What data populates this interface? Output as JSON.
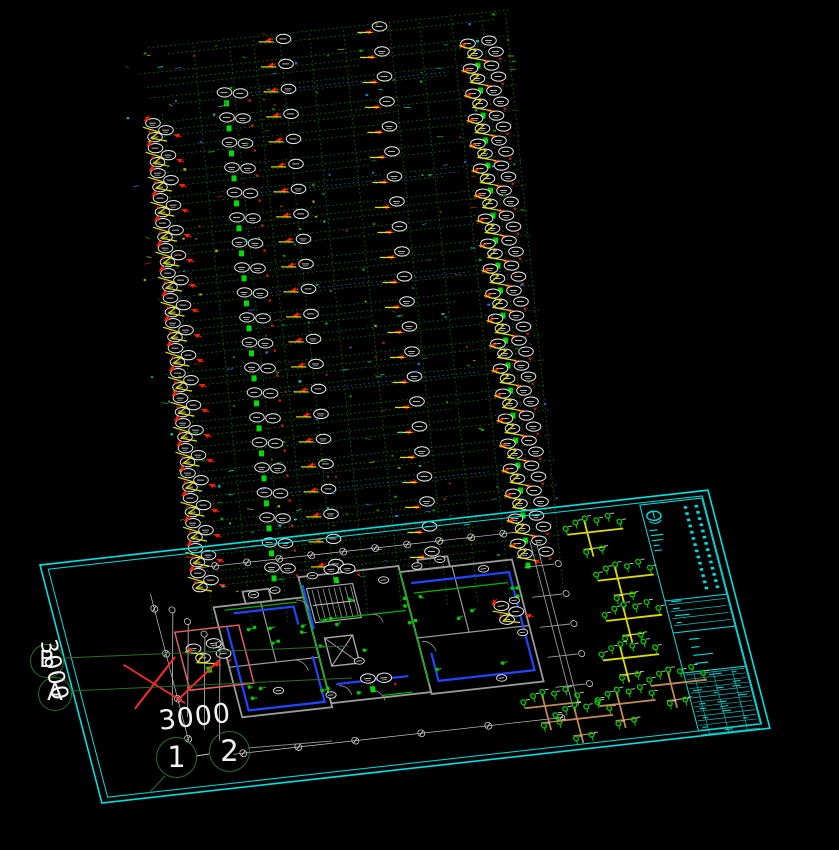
{
  "meta": {
    "app": "CAD drawing viewport",
    "description": "Electrical riser diagram above rotated floor-plan sheet with title block"
  },
  "palette": {
    "background": "#000000",
    "cyan": "#00E0E0",
    "riser_green": "#0A780A",
    "bright_green": "#00DC00",
    "symbol_green": "#00CC00",
    "yellow": "#E2E200",
    "red": "#FF1E00",
    "markup_red": "#FF2A2A",
    "highlight_red": "#E06060",
    "tan": "#C08A52",
    "blue": "#1E46FF",
    "wall_gray": "#9A9A9A",
    "dim_gray": "#C4C4C4",
    "label_white": "#E8E8E8",
    "bubble_green": "#2A6E2A",
    "text_white": "#F2F2F2"
  },
  "labels": {
    "bubble_b": "B",
    "bubble_a": "A",
    "bubble_1": "1",
    "bubble_2": "2",
    "dim_left": "3000",
    "dim_bottom": "3000"
  },
  "drawing": {
    "riser": {
      "origin": [
        213,
        38
      ],
      "shear": [
        0.1,
        -0.105
      ],
      "rows": 22,
      "row_h": 25,
      "scatter": 235,
      "v_lines": [
        -58,
        -20,
        16,
        40,
        66,
        96,
        130,
        176,
        206,
        238,
        268,
        292
      ],
      "columns": [
        {
          "u": -68,
          "type": "A",
          "from": 3
        },
        {
          "u": 6,
          "type": "B",
          "from": 2
        },
        {
          "u": 58,
          "type": "C",
          "from": 0
        },
        {
          "u": 158,
          "type": "D",
          "from": 0
        },
        {
          "u": 252,
          "type": "E",
          "from": 1
        }
      ]
    },
    "sheet": {
      "matrix": [
        1,
        -0.112,
        0.26,
        1,
        40,
        565
      ],
      "w": 668,
      "h": 238,
      "title": {
        "x": 598,
        "y": 7,
        "w": 62,
        "h": 226,
        "dash_cols": [
          640,
          651
        ],
        "dividers": [
          96,
          128,
          168
        ],
        "t0": 170,
        "rows": 13,
        "cols": [
          608,
          627,
          646
        ]
      },
      "plan": {
        "walls": [
          [
            158,
            60,
            90,
            110
          ],
          [
            248,
            40,
            100,
            126
          ],
          [
            348,
            46,
            112,
            122
          ],
          [
            190,
            48,
            26,
            12
          ],
          [
            368,
            36,
            30,
            10
          ]
        ],
        "wall_lines": [
          [
            158,
            120,
            248,
            120
          ],
          [
            348,
            112,
            460,
            112
          ],
          [
            205,
            60,
            205,
            120
          ],
          [
            400,
            46,
            400,
            112
          ]
        ],
        "stairs": [
          253,
          52,
          46,
          34
        ],
        "elevator": [
          258,
          102,
          28,
          28
        ],
        "blue": [
          [
            [
              166,
              80
            ],
            [
              166,
              164
            ],
            [
              242,
              164
            ],
            [
              242,
              118
            ]
          ],
          [
            [
              176,
              68
            ],
            [
              236,
              68
            ],
            [
              236,
              86
            ]
          ],
          [
            [
              356,
              58
            ],
            [
              454,
              58
            ],
            [
              454,
              156
            ],
            [
              358,
              156
            ],
            [
              358,
              128
            ]
          ],
          [
            [
              258,
              148
            ],
            [
              330,
              148
            ]
          ],
          [
            [
              250,
              48
            ],
            [
              250,
              92
            ]
          ]
        ],
        "green": [
          [
            [
              248,
              44
            ],
            [
              248,
              158
            ]
          ],
          [
            [
              348,
              44
            ],
            [
              348,
              158
            ]
          ],
          [
            [
              258,
              84
            ],
            [
              344,
              84
            ]
          ],
          [
            [
              168,
              64
            ],
            [
              240,
              64
            ]
          ],
          [
            [
              356,
              68
            ],
            [
              450,
              68
            ]
          ],
          [
            [
              300,
              164
            ],
            [
              330,
              164
            ]
          ]
        ],
        "green_zones": [
          [
            162,
            64,
            84,
            100
          ],
          [
            352,
            50,
            106,
            112
          ],
          [
            250,
            44,
            96,
            116
          ]
        ],
        "doors": [
          [
            222,
            120,
            12
          ],
          [
            240,
            62,
            10
          ],
          [
            352,
            116,
            11
          ],
          [
            290,
            158,
            11
          ],
          [
            310,
            84,
            9
          ],
          [
            260,
            150,
            10
          ]
        ],
        "tags": [
          [
            200,
            52
          ],
          [
            222,
            50
          ],
          [
            262,
            40
          ],
          [
            300,
            36
          ],
          [
            330,
            52
          ],
          [
            366,
            42
          ],
          [
            390,
            38
          ],
          [
            430,
            52
          ],
          [
            452,
            86
          ],
          [
            452,
            118
          ],
          [
            200,
            148
          ],
          [
            250,
            158
          ],
          [
            420,
            160
          ],
          [
            286,
            128
          ]
        ],
        "clusters": [
          {
            "t": "E",
            "x": 128,
            "y": 96
          },
          {
            "t": "A",
            "x": 438,
            "y": 92
          },
          {
            "t": "B",
            "x": 282,
            "y": 36
          },
          {
            "t": "B",
            "x": 290,
            "y": 146
          }
        ],
        "dim_lines": [
          [
            150,
            20,
            470,
            20
          ],
          [
            140,
            205,
            470,
            205
          ],
          [
            100,
            40,
            100,
            190
          ]
        ],
        "top_ticks": [
          170,
          202,
          234,
          266,
          298,
          330,
          362,
          394,
          426,
          458
        ],
        "bottom_ticks": [
          150,
          205,
          262,
          328,
          395,
          468
        ],
        "left_ticks": [
          55,
          100,
          145,
          185
        ],
        "stubs": [
          [
            117,
            61
          ],
          [
            129,
            74
          ],
          [
            142,
            88
          ],
          [
            154,
            100
          ]
        ],
        "ladder": {
          "x1": 470,
          "x2": 500,
          "ys": [
            55,
            85,
            115,
            145,
            175
          ],
          "vx": [
            482,
            488
          ],
          "vy": [
            30,
            195
          ]
        },
        "red_box": [
          114,
          80,
          64,
          58
        ],
        "red_x": [
          [
            56,
            106,
            106,
            150
          ],
          [
            56,
            150,
            108,
            104
          ],
          [
            100,
            146,
            150,
            112
          ]
        ]
      },
      "trees": [
        {
          "x": 540,
          "y": 22,
          "c": "#DCDC00"
        },
        {
          "x": 558,
          "y": 70,
          "c": "#DCDC00"
        },
        {
          "x": 556,
          "y": 110,
          "c": "#DCDC00"
        },
        {
          "x": 543,
          "y": 148,
          "c": "#DCDC00"
        },
        {
          "x": 455,
          "y": 186,
          "c": "#C08A52"
        },
        {
          "x": 483,
          "y": 202,
          "c": "#C08A52"
        },
        {
          "x": 528,
          "y": 192,
          "c": "#C08A52"
        },
        {
          "x": 583,
          "y": 178,
          "c": "#C08A52"
        }
      ]
    },
    "leaders": [
      [
        63,
        658,
        348,
        646,
        "#2A6E2A"
      ],
      [
        71,
        691,
        352,
        678,
        "#2A6E2A"
      ],
      [
        196,
        756,
        209,
        754,
        "#CCCCCC"
      ],
      [
        248,
        748,
        332,
        741,
        "#8A8A8A"
      ],
      [
        165,
        776,
        149,
        793,
        "#2A6E2A"
      ]
    ]
  }
}
